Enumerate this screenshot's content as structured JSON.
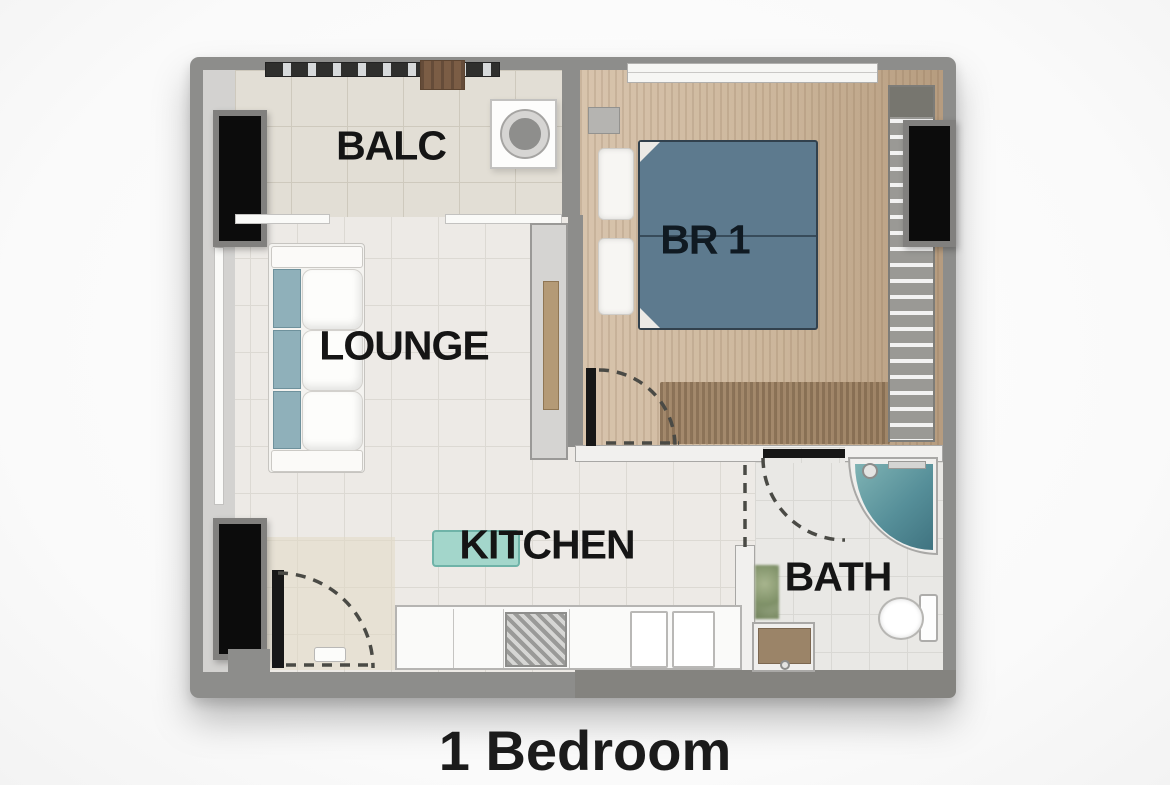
{
  "title": "1 Bedroom",
  "rooms": {
    "balcony": {
      "label": "BALC"
    },
    "lounge": {
      "label": "LOUNGE"
    },
    "bedroom": {
      "label": "BR 1"
    },
    "kitchen": {
      "label": "KITCHEN"
    },
    "bath": {
      "label": "BATH"
    }
  },
  "fixtures": [
    "balcony-railing",
    "balcony-table",
    "washing-machine",
    "sofa",
    "tv-console",
    "double-bed",
    "pillows",
    "nightstand",
    "wardrobe",
    "tv-panel",
    "kitchen-bench",
    "kitchen-counter",
    "kitchen-sink",
    "cooktop",
    "entrance-door",
    "bedroom-door",
    "bath-door",
    "corner-shower",
    "toilet",
    "vanity-basin",
    "plant"
  ],
  "colors": {
    "wall": "#8d8d8b",
    "balcony_floor": "#e2ded5",
    "lounge_floor": "#edeae6",
    "bedroom_floor": "#ccb69b",
    "bath_floor": "#e9e8e5",
    "bed": "#5d7a8e",
    "sofa_accent": "#8fb0ba",
    "kitchen_bench": "#a3d6cb",
    "shower": "#568f99",
    "vanity": "#9b8468",
    "window_panel": "#0c0c0c",
    "title_text": "#1b1b1b"
  }
}
